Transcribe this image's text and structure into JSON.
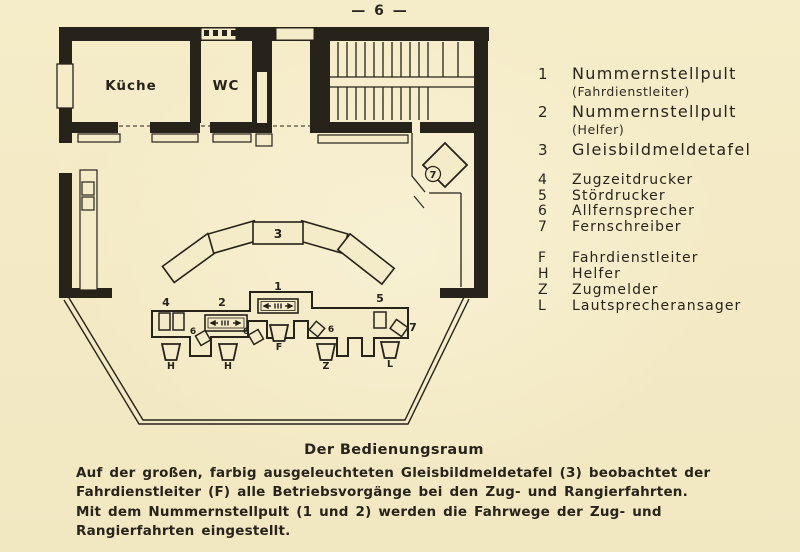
{
  "page": {
    "number_display": "—  6  —"
  },
  "plan": {
    "rooms": {
      "kitchen": "Küche",
      "wc": "WC"
    },
    "labels": {
      "panel3": "3",
      "console1": "1",
      "console2": "2",
      "printer4": "4",
      "printer5": "5",
      "phone6": "6",
      "teleprinter7": "7",
      "room7": "7",
      "seat_f": "F",
      "seat_h": "H",
      "seat_z": "Z",
      "seat_l": "L"
    }
  },
  "legend": {
    "primary": [
      {
        "key": "1",
        "label": "Nummernstellpult",
        "sub": "(Fahrdienstleiter)"
      },
      {
        "key": "2",
        "label": "Nummernstellpult",
        "sub": "(Helfer)"
      },
      {
        "key": "3",
        "label": "Gleisbildmeldetafel",
        "sub": ""
      }
    ],
    "secondary": [
      {
        "key": "4",
        "label": "Zugzeitdrucker"
      },
      {
        "key": "5",
        "label": "Stördrucker"
      },
      {
        "key": "6",
        "label": "Allfernsprecher"
      },
      {
        "key": "7",
        "label": "Fernschreiber"
      }
    ],
    "persons": [
      {
        "key": "F",
        "label": "Fahrdienstleiter"
      },
      {
        "key": "H",
        "label": "Helfer"
      },
      {
        "key": "Z",
        "label": "Zugmelder"
      },
      {
        "key": "L",
        "label": "Lautsprecheransager"
      }
    ]
  },
  "caption": {
    "title": "Der Bedienungsraum",
    "paragraphs": [
      "Auf der großen, farbig ausgeleuchteten Gleisbildmeldetafel (3) beobachtet der Fahrdienstleiter (F) alle Betriebsvorgänge bei den Zug- und Rangierfahrten.",
      "Mit dem Nummernstellpult (1 und 2) werden die Fahrwege der Zug- und Rangierfahrten eingestellt."
    ]
  },
  "colors": {
    "paper": "#f4ebc8",
    "ink": "#27221a"
  }
}
